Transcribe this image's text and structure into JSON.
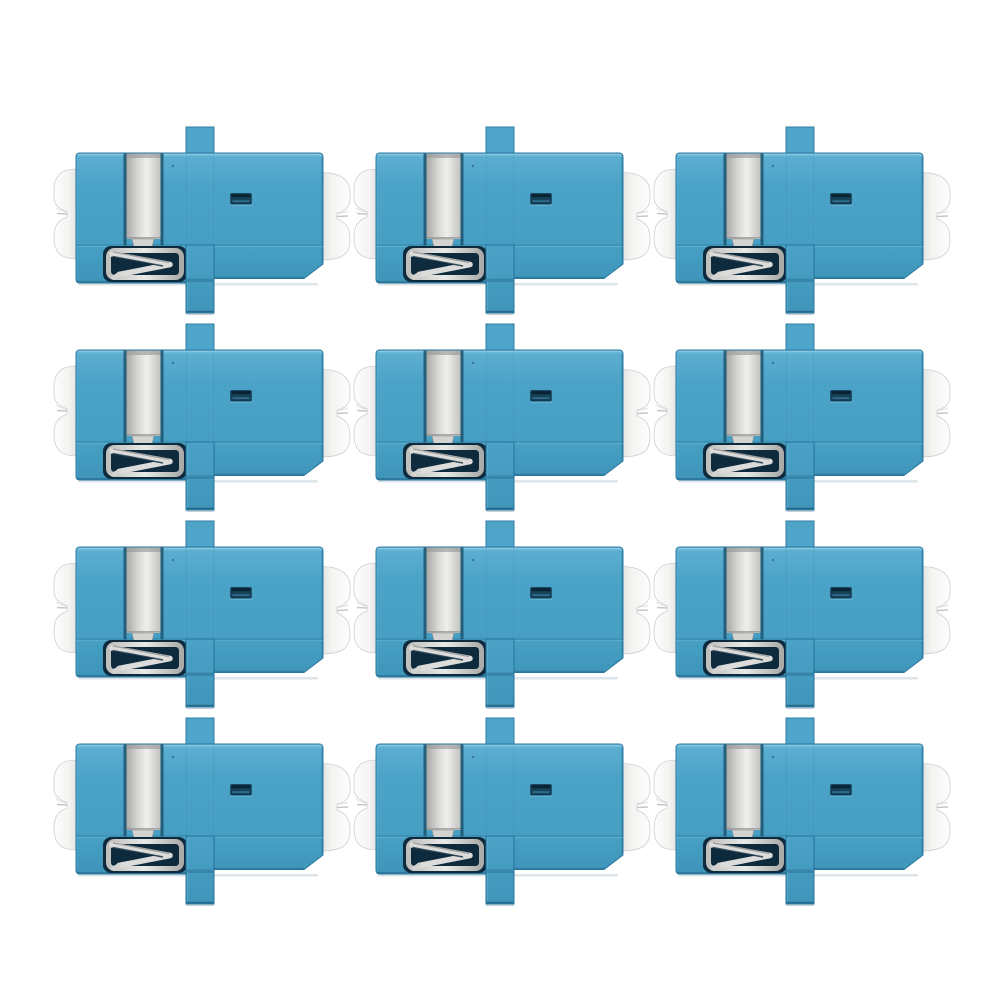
{
  "page": {
    "background": "#FFFFFF",
    "content": "product-photo"
  },
  "grid": {
    "rows": 4,
    "cols": 3,
    "count": 12
  },
  "item": {
    "name": "lc-duplex-fiber-optic-adapter",
    "orientation": "horizontal, latch side left, mounting flange vertical"
  },
  "colors": {
    "body_blue": "#4BA3C8",
    "body_blue_light": "#8FCBE2",
    "body_blue_dark": "#2A77A0",
    "flange_blue": "#4FA5C9",
    "metal_light": "#EFEFED",
    "metal_mid": "#C9C9C7",
    "metal_dark": "#9A9A98",
    "latch_recess": "#0E2B3D",
    "slot_dark": "#174258",
    "dust_cap_white": "#F7F7F6",
    "background": "#FFFFFF"
  }
}
